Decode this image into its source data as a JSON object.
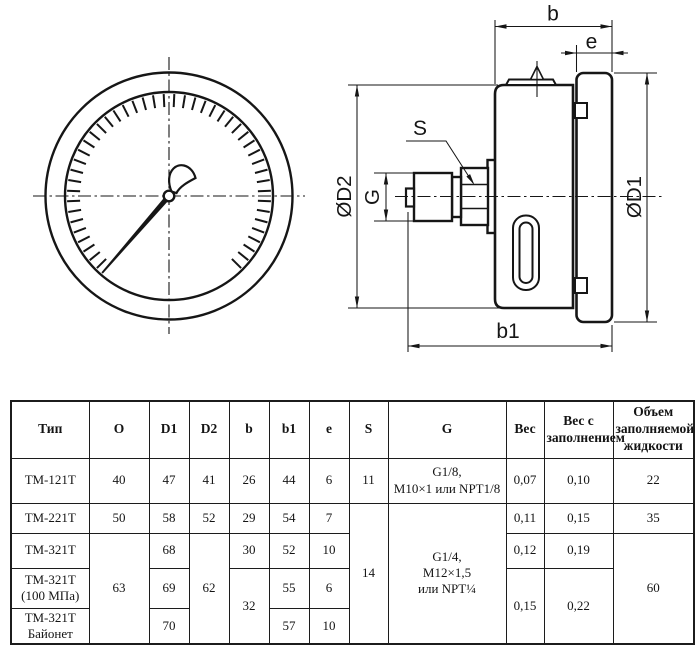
{
  "drawing": {
    "labels": {
      "b": "b",
      "e": "e",
      "s": "S",
      "g": "G",
      "d1": "ØD1",
      "d2": "ØD2",
      "b1": "b1"
    }
  },
  "table": {
    "headers": {
      "type": "Тип",
      "o": "O",
      "d1": "D1",
      "d2": "D2",
      "b": "b",
      "b1": "b1",
      "e": "e",
      "s": "S",
      "g": "G",
      "w": "Вес",
      "wf": "Вес с\nзаполнением",
      "vol": "Объем\nзаполняемой\nжидкости"
    },
    "rows": {
      "r1": {
        "type": "ТМ-121Т",
        "o": "40",
        "d1": "47",
        "d2": "41",
        "b": "26",
        "b1": "44",
        "e": "6",
        "s": "11",
        "g": "G1/8,\nМ10×1 или NPT1/8",
        "w": "0,07",
        "wf": "0,10",
        "vol": "22"
      },
      "r2": {
        "type": "ТМ-221Т",
        "o": "50",
        "d1": "58",
        "d2": "52",
        "b": "29",
        "b1": "54",
        "e": "7",
        "s": "14",
        "g": "G1/4,\nМ12×1,5\nили NPT¼",
        "w": "0,11",
        "wf": "0,15",
        "vol": "35"
      },
      "r3": {
        "type": "ТМ-321Т",
        "o": "63",
        "d1": "68",
        "d2": "62",
        "b": "30",
        "b1": "52",
        "e": "10",
        "w": "0,12",
        "wf": "0,19",
        "vol": "60"
      },
      "r4": {
        "type": "ТМ-321Т\n(100 МПа)",
        "d1": "69",
        "b": "32",
        "b1": "55",
        "e": "6",
        "w": "0,15",
        "wf": "0,22"
      },
      "r5": {
        "type": "ТМ-321Т\nБайонет",
        "d1": "70",
        "b1": "57",
        "e": "10"
      }
    }
  }
}
